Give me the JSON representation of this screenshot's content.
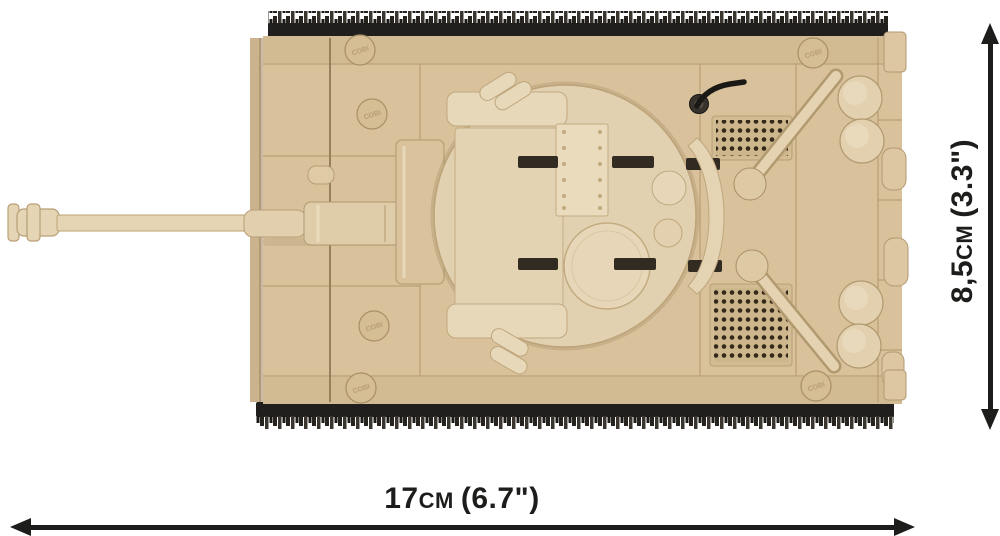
{
  "product_image": {
    "subject": "COBI brick tank model, top view",
    "stud_label": "COBI",
    "colors": {
      "background": "#ffffff",
      "brick_tan": "#d8c19b",
      "brick_tan_light": "#e7d6b6",
      "brick_tan_dark": "#b79e74",
      "track_black": "#211f1d"
    }
  },
  "dimension_labels": {
    "annotation_color": "#1d1d1b",
    "width": {
      "value": "17",
      "unit": "cm",
      "imperial": "(6.7\")"
    },
    "height": {
      "value": "8,5",
      "unit": "cm",
      "imperial": "(3.3\")"
    }
  }
}
